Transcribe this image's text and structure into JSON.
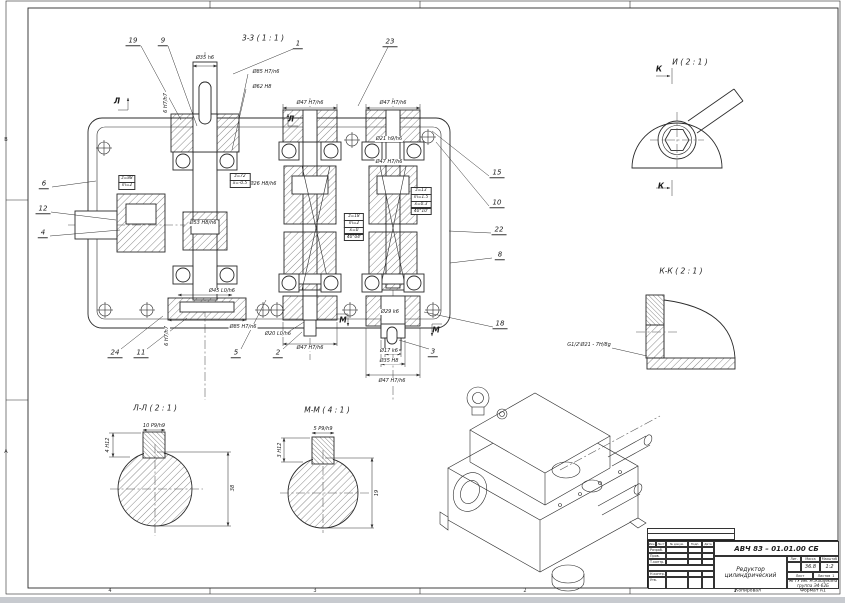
{
  "sheet": {
    "copied": "Копировал",
    "format": "Формат А1",
    "zones_bottom": [
      {
        "t": "4",
        "x": 110,
        "y": 591
      },
      {
        "t": "3",
        "x": 315,
        "y": 591
      },
      {
        "t": "2",
        "x": 525,
        "y": 591
      },
      {
        "t": "1",
        "x": 735,
        "y": 591
      }
    ],
    "zones_left": [
      {
        "t": "В",
        "x": 3,
        "y": 140
      },
      {
        "t": "А",
        "x": 3,
        "y": 452
      }
    ]
  },
  "sections": {
    "main": "3-3 ( 1 : 1 )",
    "detail_i": "И ( 2 : 1 )",
    "kk": "К-К ( 2 : 1 )",
    "ll": "Л-Л ( 2 : 1 )",
    "mm": "М-М ( 4 : 1 )"
  },
  "marks": [
    {
      "t": "Л",
      "x": 117,
      "y": 101
    },
    {
      "t": "Л",
      "x": 291,
      "y": 119
    },
    {
      "t": "М",
      "x": 343,
      "y": 320
    },
    {
      "t": "М",
      "x": 436,
      "y": 330
    },
    {
      "t": "К",
      "x": 659,
      "y": 69
    },
    {
      "t": "К",
      "x": 661,
      "y": 186
    }
  ],
  "callouts": [
    {
      "n": "19",
      "x": 133,
      "y": 41
    },
    {
      "n": "9",
      "x": 163,
      "y": 41
    },
    {
      "n": "1",
      "x": 298,
      "y": 44
    },
    {
      "n": "23",
      "x": 390,
      "y": 42
    },
    {
      "n": "15",
      "x": 497,
      "y": 173
    },
    {
      "n": "10",
      "x": 497,
      "y": 203
    },
    {
      "n": "22",
      "x": 499,
      "y": 230
    },
    {
      "n": "8",
      "x": 500,
      "y": 255
    },
    {
      "n": "18",
      "x": 500,
      "y": 324
    },
    {
      "n": "6",
      "x": 44,
      "y": 184
    },
    {
      "n": "12",
      "x": 43,
      "y": 209
    },
    {
      "n": "4",
      "x": 43,
      "y": 233
    },
    {
      "n": "24",
      "x": 115,
      "y": 353
    },
    {
      "n": "11",
      "x": 141,
      "y": 353
    },
    {
      "n": "5",
      "x": 236,
      "y": 353
    },
    {
      "n": "2",
      "x": 278,
      "y": 353
    },
    {
      "n": "3",
      "x": 433,
      "y": 352
    }
  ],
  "dims": [
    {
      "t": "Ø35 h6",
      "x": 205,
      "y": 58
    },
    {
      "t": "Ø85 H7/n6",
      "x": 266,
      "y": 72
    },
    {
      "t": "Ø62 H8",
      "x": 262,
      "y": 87
    },
    {
      "t": "Ø47 H7/h6",
      "x": 310,
      "y": 103
    },
    {
      "t": "Ø47 H7/h6",
      "x": 393,
      "y": 103
    },
    {
      "t": "Ø21 h9/h6",
      "x": 389,
      "y": 139
    },
    {
      "t": "Ø26 H8/h6",
      "x": 263,
      "y": 184
    },
    {
      "t": "Ø47 H7/h6",
      "x": 389,
      "y": 162
    },
    {
      "t": "Ø53 H8/h6",
      "x": 203,
      "y": 223
    },
    {
      "t": "Ø45 L0/h6",
      "x": 222,
      "y": 291
    },
    {
      "t": "Ø85 H7/n6",
      "x": 243,
      "y": 327
    },
    {
      "t": "Ø20 L0/h6",
      "x": 278,
      "y": 334
    },
    {
      "t": "Ø47 H7/h6",
      "x": 310,
      "y": 348
    },
    {
      "t": "Ø29 k6",
      "x": 390,
      "y": 312
    },
    {
      "t": "Ø17 k6",
      "x": 389,
      "y": 351
    },
    {
      "t": "Ø35 H8",
      "x": 389,
      "y": 361
    },
    {
      "t": "Ø47 H7/h6",
      "x": 392,
      "y": 381
    },
    {
      "t": "6 H7/h7",
      "x": 166,
      "y": 103,
      "r": -90
    },
    {
      "t": "6 H7/h7",
      "x": 167,
      "y": 336,
      "r": -90
    },
    {
      "t": "10 P9/h9",
      "x": 154,
      "y": 426
    },
    {
      "t": "4 H12",
      "x": 108,
      "y": 445,
      "r": -90
    },
    {
      "t": "38",
      "x": 233,
      "y": 488,
      "r": -90
    },
    {
      "t": "5 P9/h9",
      "x": 323,
      "y": 429
    },
    {
      "t": "3 H12",
      "x": 280,
      "y": 450,
      "r": -90
    },
    {
      "t": "19",
      "x": 377,
      "y": 493,
      "r": -90
    },
    {
      "t": "G1/2'Ø21 - 7H/8g",
      "x": 589,
      "y": 345
    }
  ],
  "gear_tables": [
    {
      "x": 127,
      "y": 176,
      "rows": [
        "z=88",
        "m=2"
      ]
    },
    {
      "x": 240,
      "y": 174,
      "rows": [
        "z=72",
        "x=-0.5"
      ]
    },
    {
      "x": 354,
      "y": 214,
      "rows": [
        "z=18",
        "m=2",
        "x=0",
        "40°04'"
      ]
    },
    {
      "x": 421,
      "y": 188,
      "rows": [
        "z=13",
        "m=1.5",
        "x=0.3",
        "40°10'"
      ]
    }
  ],
  "title_block": {
    "doc_number": "АВЧ 83 – 01.01.00 СБ",
    "title": "Редуктор цилиндрический",
    "lit_label": "Лит.",
    "mass_label": "Масса",
    "scale_label": "Масштаб",
    "mass": "36.8",
    "scale": "1:2",
    "sheet_label": "Лист",
    "sheets_label": "Листов",
    "sheets_value": "1",
    "org_line1": "МГТУ им. Н.Э.Баумана",
    "org_line2": "группа Э4-62Б",
    "cols": {
      "izm": "Изм.",
      "list": "Лист",
      "doc": "№ докум.",
      "podp": "Подп.",
      "data": "Дата"
    },
    "rows": {
      "razrab": "Разраб.",
      "prov": "Пров.",
      "tkontr": "Т.контр.",
      "nkontr": "Н.контр.",
      "utv": "Утв."
    }
  }
}
